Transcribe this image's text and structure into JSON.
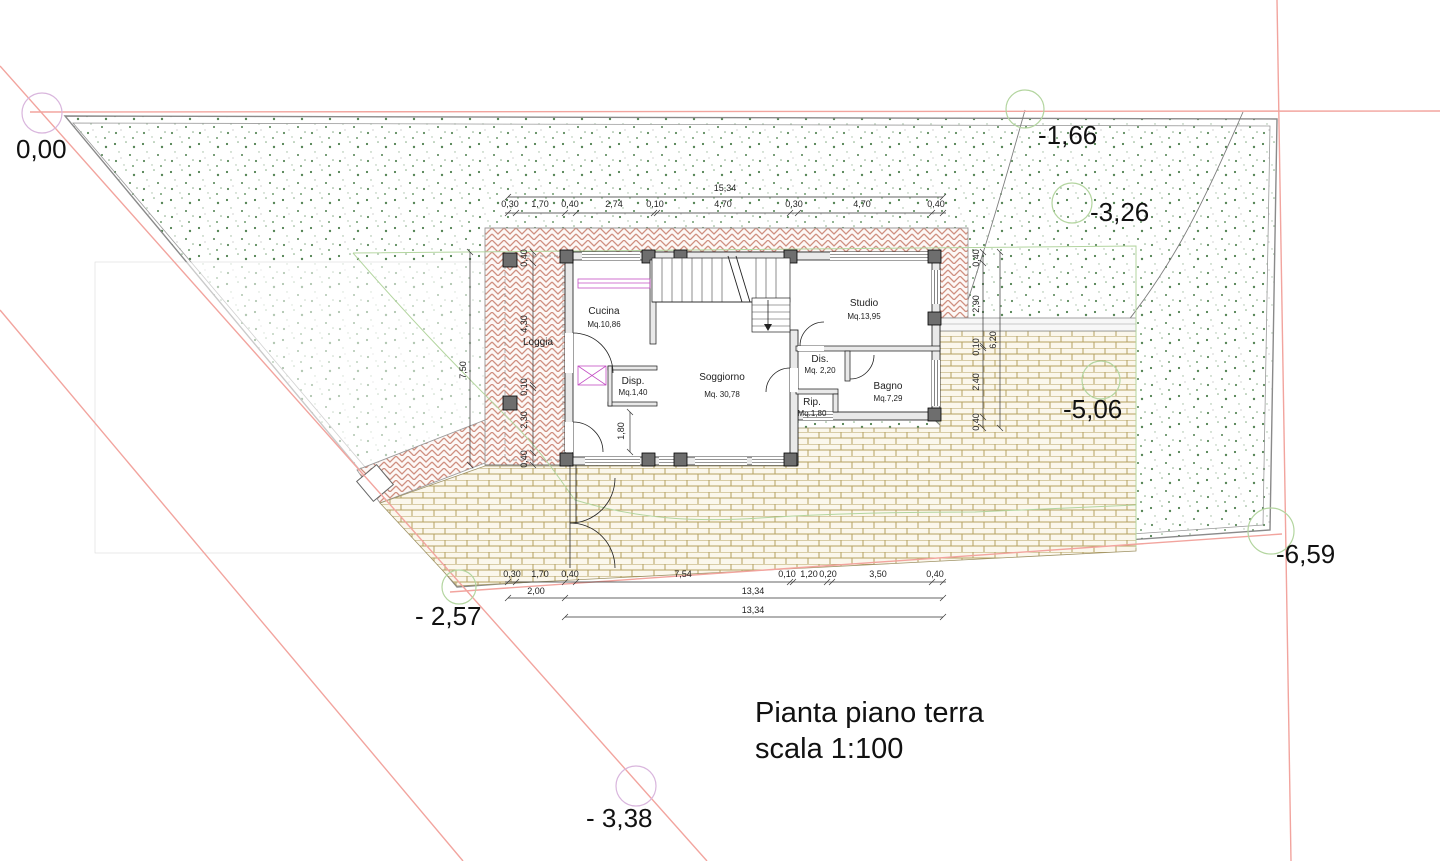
{
  "title": {
    "line1": "Pianta piano terra",
    "line2": "scala 1:100"
  },
  "elevations": {
    "p0": "0,00",
    "p1": "-1,66",
    "p2": "-3,26",
    "p3": "-5,06",
    "p4": "-6,59",
    "p5": "- 2,57",
    "p6": "- 3,38"
  },
  "rooms": {
    "cucina": {
      "name": "Cucina",
      "area": "Mq.10,86"
    },
    "soggiorno": {
      "name": "Soggiorno",
      "area": "Mq. 30,78"
    },
    "studio": {
      "name": "Studio",
      "area": "Mq.13,95"
    },
    "dis": {
      "name": "Dis.",
      "area": "Mq. 2,20"
    },
    "bagno": {
      "name": "Bagno",
      "area": "Mq.7,29"
    },
    "disp": {
      "name": "Disp.",
      "area": "Mq.1,40"
    },
    "rip": {
      "name": "Rip.",
      "area": "Mq.1,80"
    },
    "loggia": {
      "name": "Loggia"
    }
  },
  "dimensions": {
    "top_total": "15,34",
    "top_segments": [
      "0,30",
      "1,70",
      "0,40",
      "2,74",
      "0,10",
      "4,70",
      "0,30",
      "4,70",
      "0,40"
    ],
    "left_total": "7,50",
    "loggia_segments": [
      "0,40",
      "4,30",
      "0,10",
      "2,30",
      "0,40"
    ],
    "right_total": "6,20",
    "right_segments": [
      "0,40",
      "2,90",
      "0,10",
      "2,40",
      "0,40"
    ],
    "bottom_segments": [
      "0,30",
      "1,70",
      "0,40",
      "7,54",
      "0,10",
      "1,20",
      "0,20",
      "3,50",
      "0,40"
    ],
    "bottom_row2": [
      "2,00",
      "13,34"
    ],
    "bottom_row3": "13,34",
    "interior_door": "1,80"
  },
  "colors": {
    "boundary_red": "#f2a49e",
    "contour_green": "#b3d59f",
    "benchmark_pink": "#d9b6dd",
    "herringbone": "#cf8f80",
    "brick": "#b5a061"
  }
}
